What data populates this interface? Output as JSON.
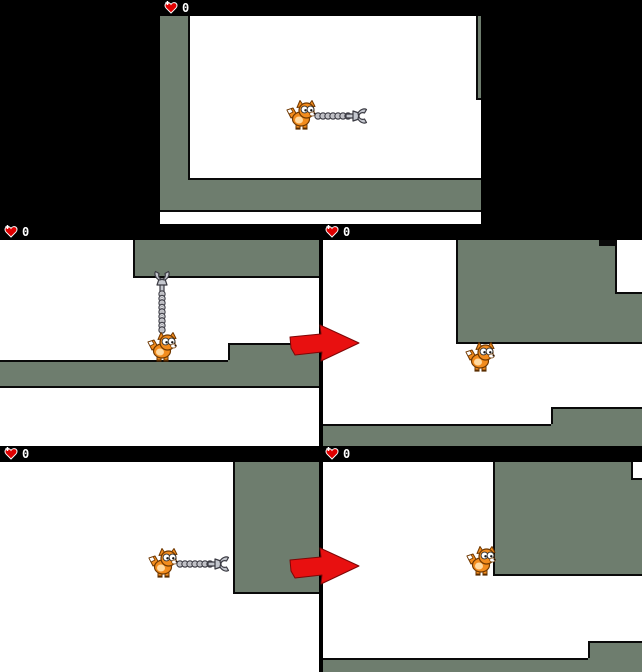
{
  "panels": [
    {
      "id": "top",
      "hud_value": "0"
    },
    {
      "id": "middle-left",
      "hud_value": "0"
    },
    {
      "id": "middle-right",
      "hud_value": "0"
    },
    {
      "id": "bottom-left",
      "hud_value": "0"
    },
    {
      "id": "bottom-right",
      "hud_value": "0"
    }
  ],
  "hud": {
    "icon": "heart-icon",
    "text_color": "#ffffff"
  },
  "sprites": {
    "player": "fox-sprite",
    "weapon": "grapple-claw-icon",
    "tether": "chain-links",
    "hint": "red-arrow-icon"
  },
  "colors": {
    "background": "#000000",
    "playfield": "#ffffff",
    "terrain": "#6e7d6e",
    "outline": "#0a0a0a",
    "heart_red": "#e00000",
    "arrow_red": "#e81010",
    "fox_orange": "#f28c1e",
    "chain_gray": "#d7d8dd"
  }
}
